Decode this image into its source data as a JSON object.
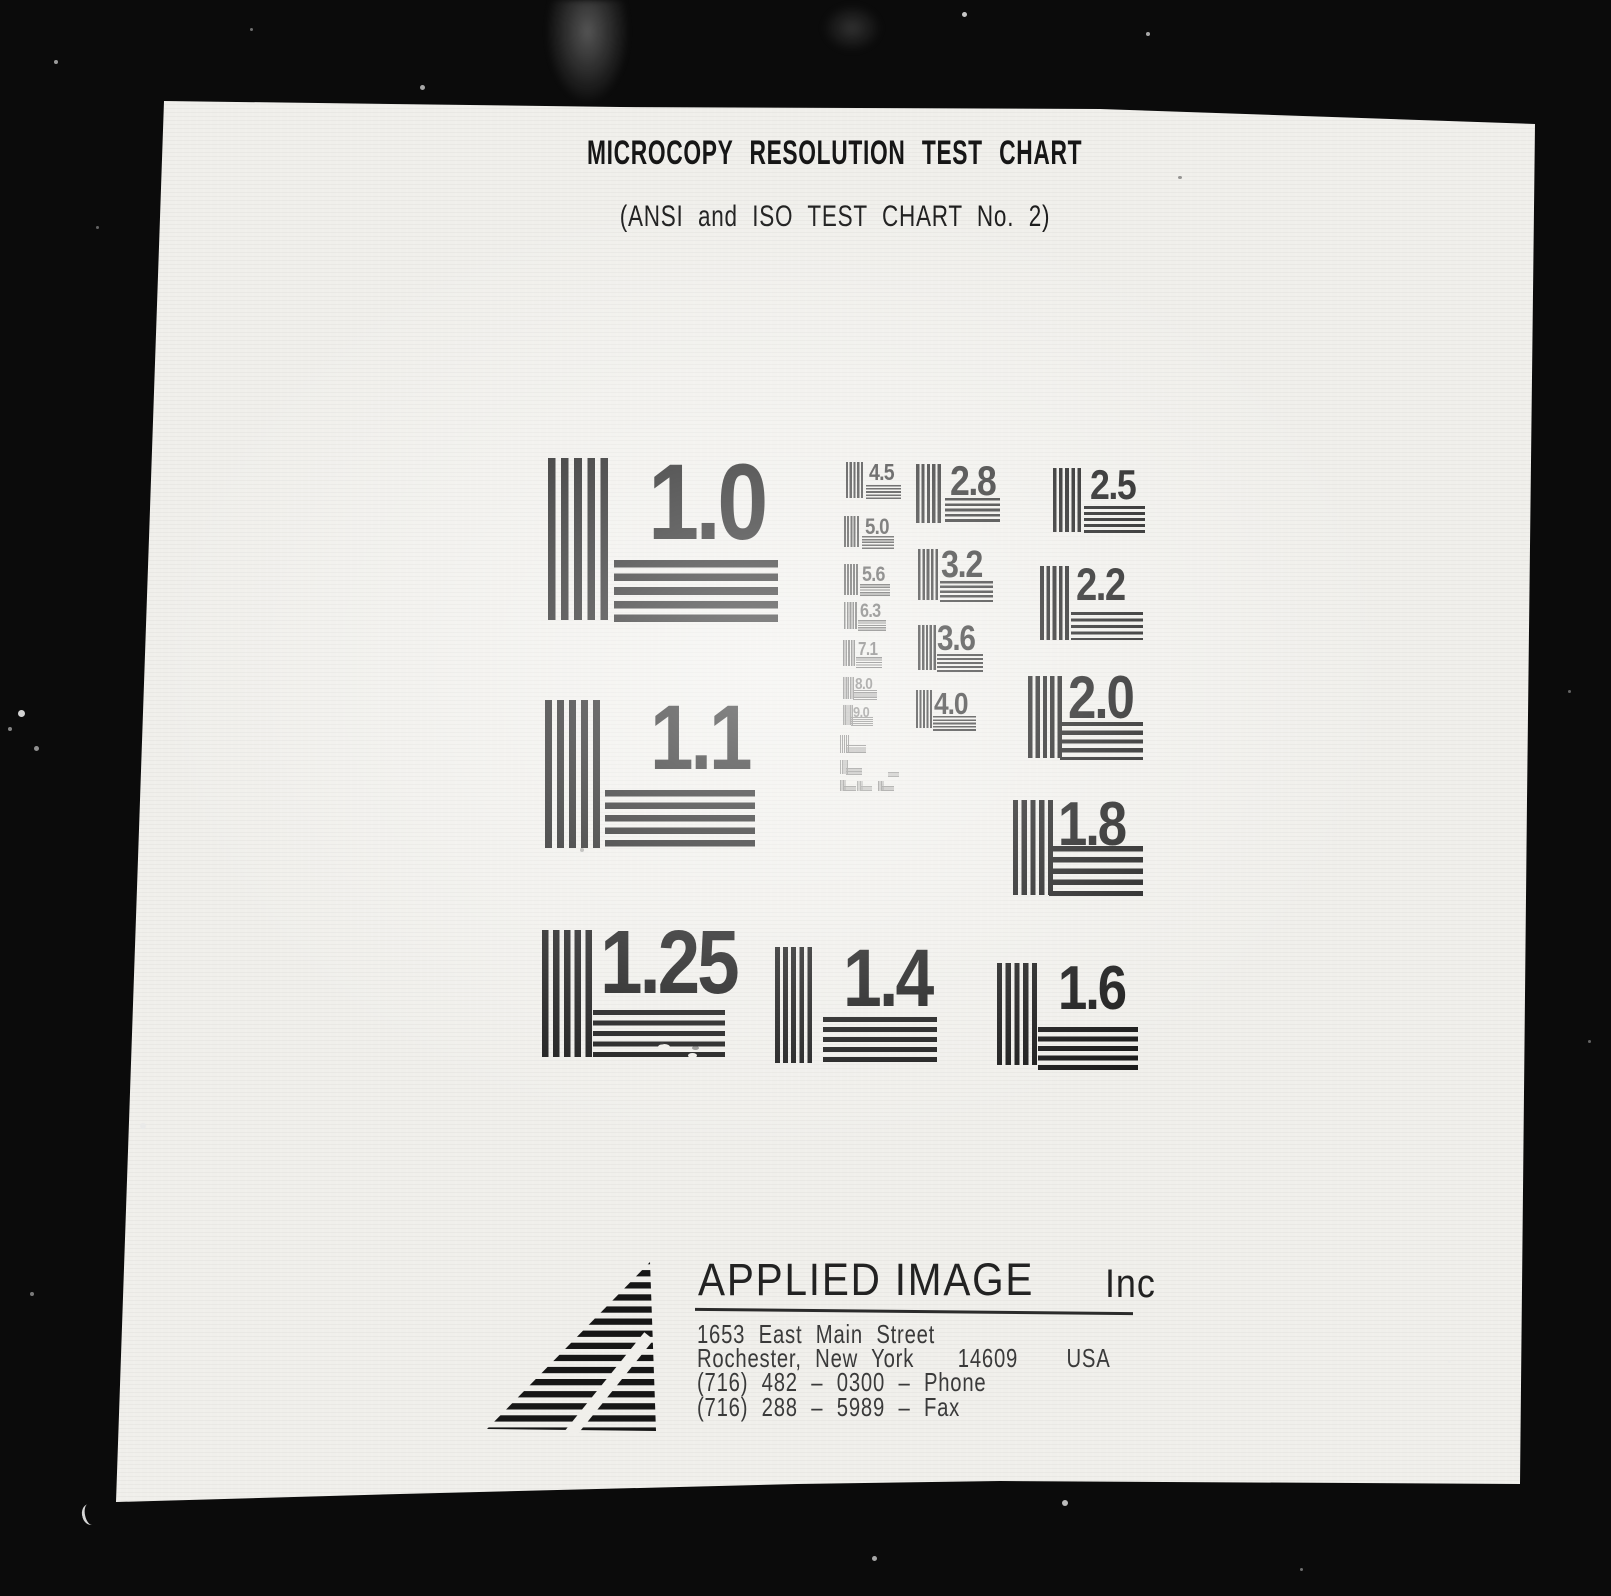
{
  "header": {
    "title": "MICROCOPY RESOLUTION TEST CHART",
    "subtitle": "(ANSI and ISO TEST CHART No. 2)"
  },
  "patterns": {
    "large": [
      {
        "label": "1.0"
      },
      {
        "label": "1.1"
      },
      {
        "label": "1.25"
      },
      {
        "label": "1.4"
      },
      {
        "label": "1.6"
      },
      {
        "label": "1.8"
      },
      {
        "label": "2.0"
      },
      {
        "label": "2.2"
      },
      {
        "label": "2.5"
      },
      {
        "label": "2.8"
      },
      {
        "label": "3.2"
      },
      {
        "label": "3.6"
      },
      {
        "label": "4.0"
      }
    ],
    "small": [
      {
        "label": "4.5"
      },
      {
        "label": "5.0"
      },
      {
        "label": "5.6"
      },
      {
        "label": "6.3"
      },
      {
        "label": "7.1"
      },
      {
        "label": "8.0"
      },
      {
        "label": "9.0"
      }
    ]
  },
  "footer": {
    "company": "APPLIED IMAGE",
    "company_suffix": "Inc",
    "address_line1": "1653 East Main Street",
    "city_line": "Rochester, New York",
    "postal_code": "14609",
    "country": "USA",
    "phone_line": "(716) 482 – 0300 – Phone",
    "fax_line": "(716) 288 – 5989 – Fax"
  },
  "colors": {
    "background": "#0b0b0b",
    "paper": "#f0efeb",
    "ink": "#1a1a1a"
  }
}
